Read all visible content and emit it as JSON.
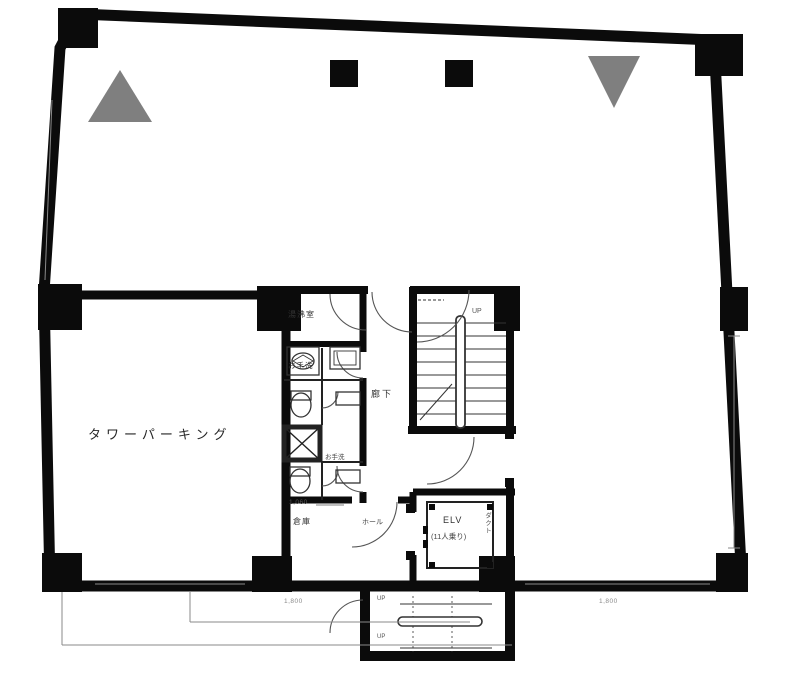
{
  "drawing": {
    "type": "building-floor-plan",
    "colors": {
      "wall": "#0b0b0b",
      "background": "#ffffff",
      "thin_line": "#333333",
      "door_arc": "#555555",
      "faint_line": "#8a8a8a",
      "marker_triangle": "#7f7f7f"
    },
    "labels": {
      "tower_parking": "タワーパーキング",
      "kitchenette": "湯沸室",
      "restroom_upper": "お手洗",
      "corridor": "廊下",
      "restroom_lower": "お手洗",
      "storage": "倉庫",
      "hall": "ホール",
      "elevator": "ELV",
      "elevator_capacity": "(11人乗り)",
      "duct": "ダクト",
      "stairs_up_center": "UP",
      "stairs_up_bottom_1": "UP",
      "stairs_up_bottom_2": "UP",
      "dim_storage": "1,060",
      "dim_bottom_left": "1,800",
      "dim_bottom_right": "1,800"
    }
  }
}
